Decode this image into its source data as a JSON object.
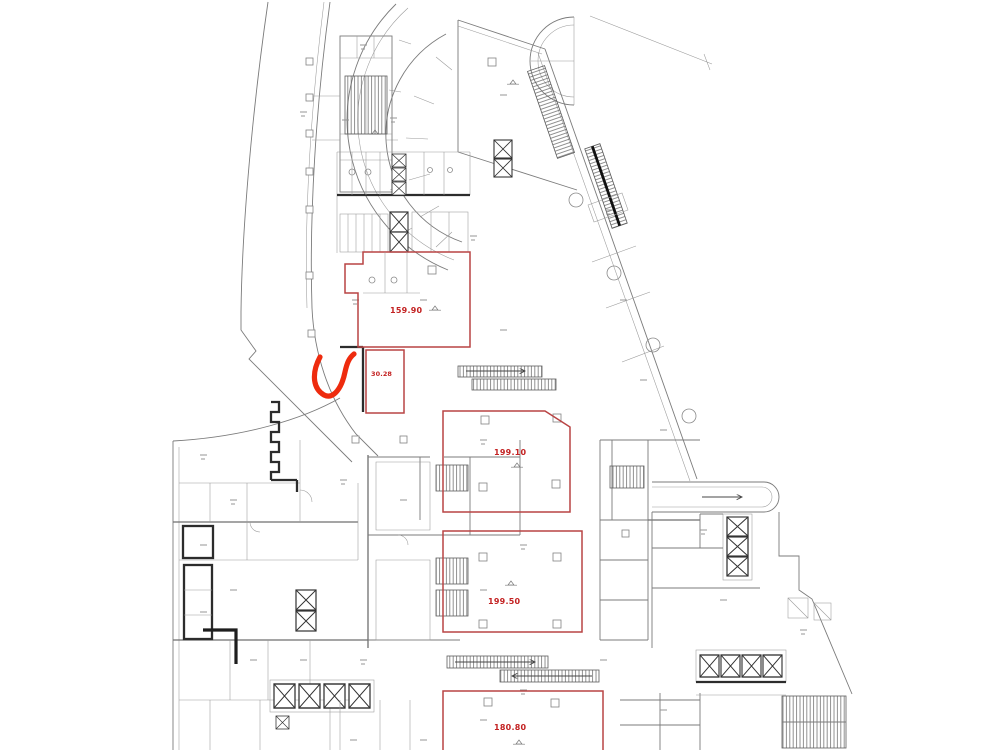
{
  "plan": {
    "type": "architectural-floor-plan-scan",
    "background": "#ffffff",
    "line_color": "#7b7b7b",
    "wall_color": "#2c2c2c",
    "red_outline_color": "#b94444",
    "red_label_color": "#c32222",
    "annotation_color": "#ee2b0e",
    "rooms": [
      {
        "id": "159-90",
        "area_label": "159.90"
      },
      {
        "id": "30-28",
        "area_label": "30.28"
      },
      {
        "id": "199-10",
        "area_label": "199.10"
      },
      {
        "id": "199-50",
        "area_label": "199.50"
      },
      {
        "id": "180-80",
        "area_label": "180.80"
      }
    ],
    "annotations": [
      {
        "id": "checkmark",
        "type": "handwritten-check"
      }
    ]
  }
}
